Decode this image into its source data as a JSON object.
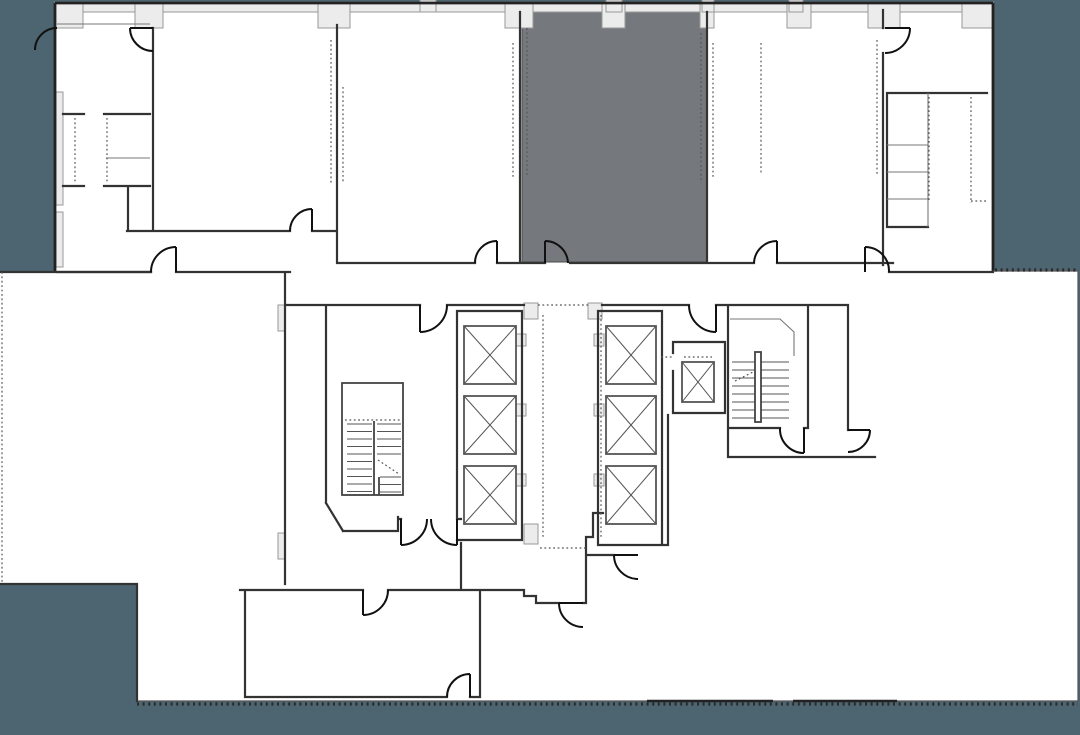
{
  "document": {
    "kind": "architectural-floor-plan",
    "description": "Office floor plan with central elevator core, two stairwells and one highlighted suite"
  },
  "colors": {
    "background": "#4c6570",
    "plan_fill": "#ffffff",
    "highlighted_suite": "#75797d",
    "wall": "#333333",
    "light_wall_fill": "#ececec",
    "dotted_line": "#555555"
  },
  "features": {
    "highlighted_suite_count": 1,
    "elevator_count": 7,
    "elevator_banks": 2,
    "service_elevator_count": 1,
    "stairwell_count": 2
  }
}
